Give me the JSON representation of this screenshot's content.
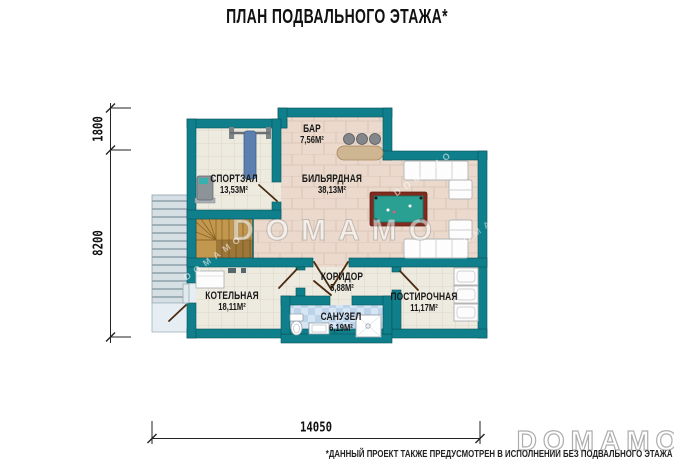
{
  "title": "ПЛАН ПОДВАЛЬНОГО ЭТАЖА*",
  "rooms": {
    "gym": {
      "name": "СПОРТЗАЛ",
      "area": "13,53М²"
    },
    "bar": {
      "name": "БАР",
      "area": "7,56М²"
    },
    "billiard": {
      "name": "БИЛЬЯРДНАЯ",
      "area": "38,13М²"
    },
    "corridor": {
      "name": "КОРИДОР",
      "area": "5,88М²"
    },
    "boiler": {
      "name": "КОТЕЛЬНАЯ",
      "area": "18,11М²"
    },
    "bathroom": {
      "name": "САНУЗЕЛ",
      "area": "6,19М²"
    },
    "laundry": {
      "name": "ПОСТИРОЧНАЯ",
      "area": "11,17М²"
    }
  },
  "dimensions": {
    "left_top": "1800",
    "left_bottom": "8200",
    "bottom": "14050"
  },
  "watermark": {
    "text": "DOMAMO"
  },
  "footnote": "*ДАННЫЙ ПРОЕКТ ТАКЖЕ ПРЕДУСМОТРЕН В ИСПОЛНЕНИИ БЕЗ ПОДВАЛЬНОГО ЭТАЖА",
  "colors": {
    "wall": "#0e7f8b",
    "floor_warm": "#ead9cc",
    "floor_cream": "#edeadf",
    "floor_bath": "#cfe1f2",
    "wood": "#c2974e",
    "billiard_felt": "#2aa092",
    "text": "#1a1a1a"
  }
}
